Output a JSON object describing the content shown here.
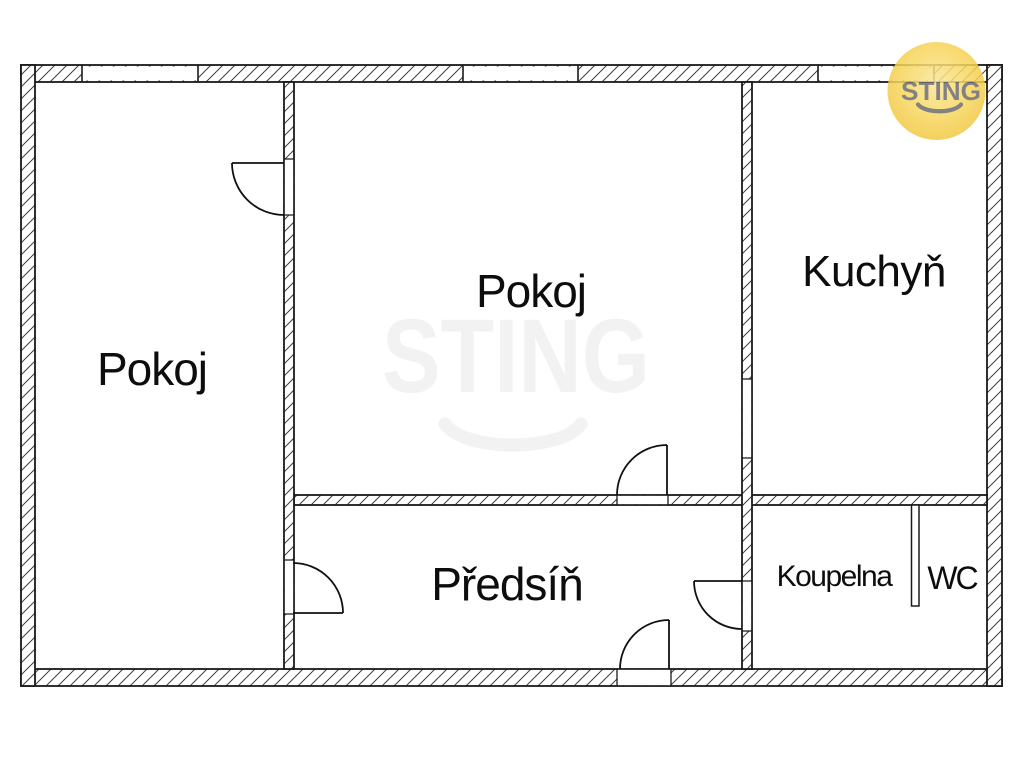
{
  "rooms": [
    {
      "name": "pokoj-left",
      "label": "Pokoj"
    },
    {
      "name": "pokoj-center",
      "label": "Pokoj"
    },
    {
      "name": "kuchyn",
      "label": "Kuchyň"
    },
    {
      "name": "predsin",
      "label": "Předsíň"
    },
    {
      "name": "koupelna",
      "label": "Koupelna"
    },
    {
      "name": "wc",
      "label": "WC"
    }
  ],
  "watermark": {
    "text": "STING"
  },
  "logo": {
    "text": "STING"
  },
  "colors": {
    "wall_line": "#1a1a1a",
    "hatch_line": "#404040",
    "watermark_gray": "#f2f2f2",
    "logo_text_gray": "#6d6d6d",
    "logo_yellow_center": "#fbe79a",
    "logo_yellow_mid": "#f7d75f",
    "logo_yellow_edge": "#f1c53e"
  }
}
